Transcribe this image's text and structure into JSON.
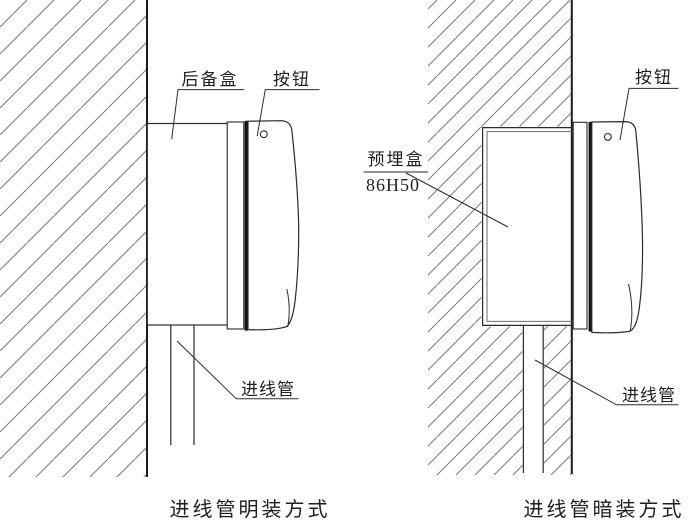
{
  "left_diagram": {
    "labels": {
      "backup_box": "后备盒",
      "button": "按钮",
      "inlet_conduit": "进线管"
    },
    "caption": "进线管明装方式"
  },
  "right_diagram": {
    "labels": {
      "embedded_box": "预埋盒",
      "embedded_box_model": "86H50",
      "button": "按钮",
      "inlet_conduit": "进线管"
    },
    "caption": "进线管暗装方式"
  },
  "colors": {
    "outline": "#2b2b2b",
    "wall_face": "#1b1b1b",
    "hatch": "#777777",
    "background": "#ffffff"
  }
}
